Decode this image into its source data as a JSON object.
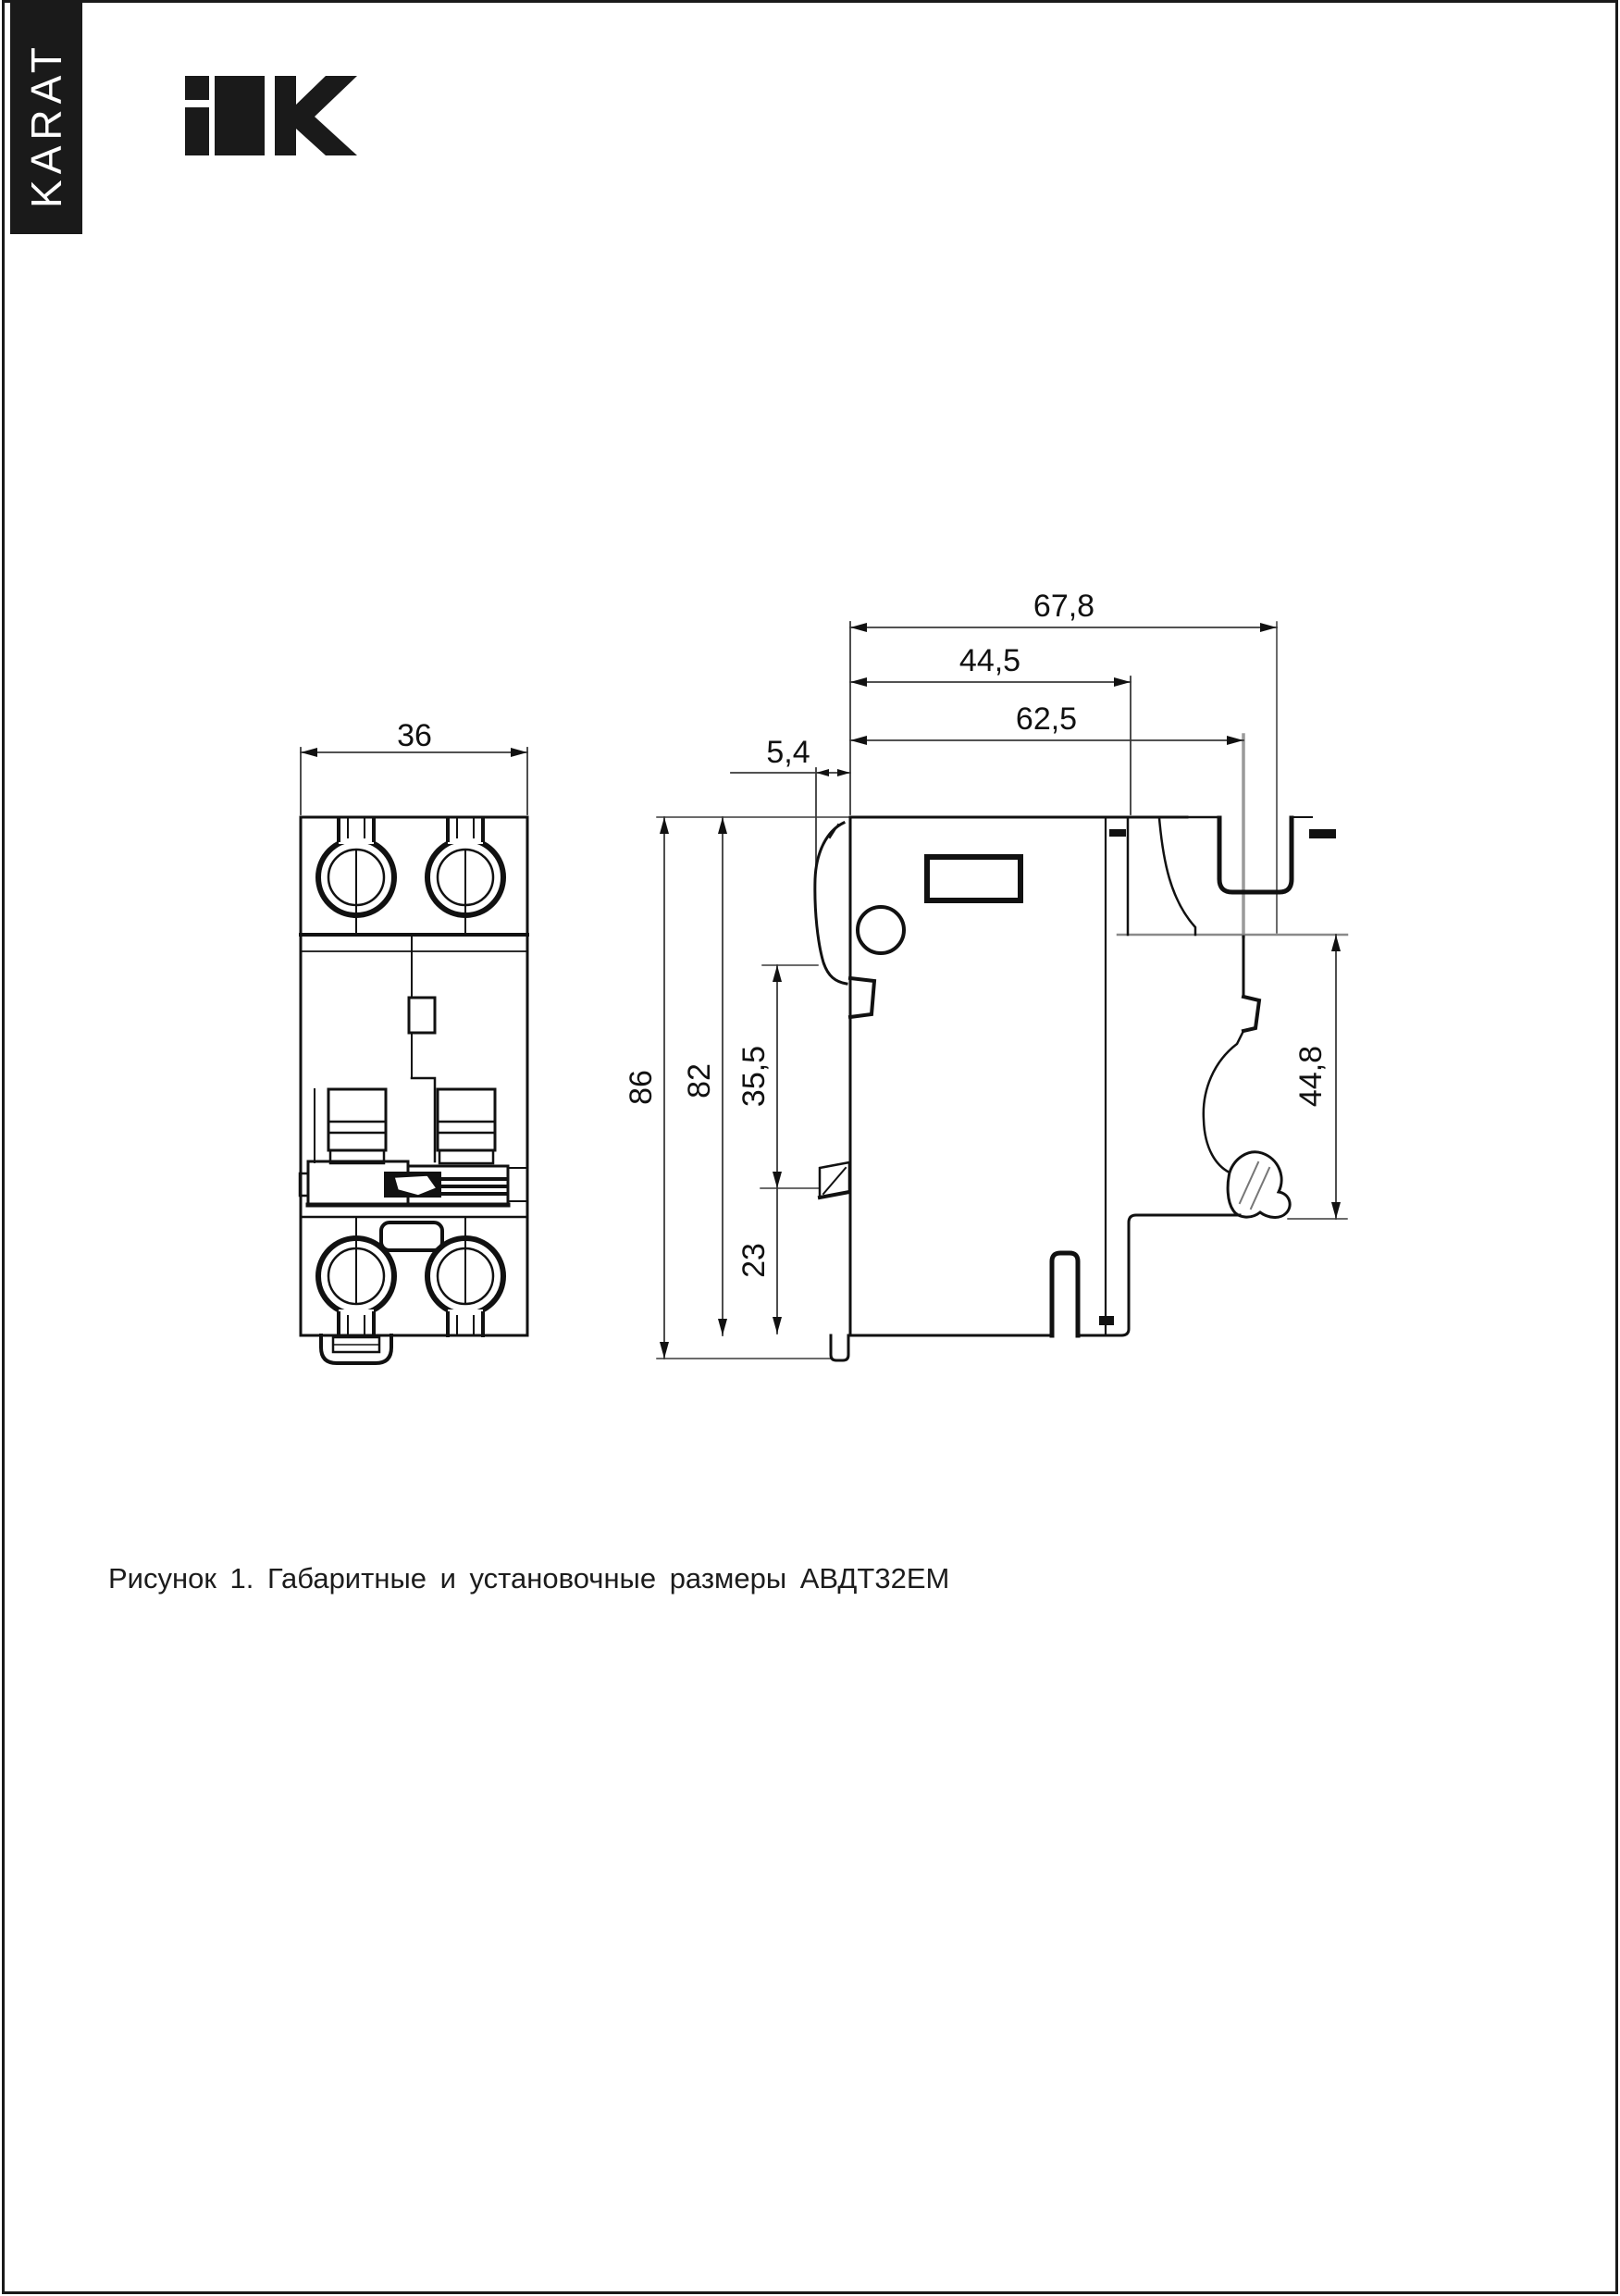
{
  "page": {
    "background": "#ffffff",
    "frame_color": "#1a1a1a"
  },
  "sidebar": {
    "series_label": "KARAT",
    "bg_color": "#1a1a1a",
    "text_color": "#ffffff"
  },
  "logo": {
    "brand": "IEK",
    "color": "#1a1a1a"
  },
  "figure": {
    "caption": "Рисунок 1. Габаритные и установочные размеры АВДТ32ЕМ",
    "front_view": {
      "width_mm": "36"
    },
    "side_view": {
      "overall_depth_mm": "67,8",
      "upper_depth_mm": "44,5",
      "rear_depth_mm": "62,5",
      "lever_protrusion_mm": "5,4",
      "overall_height_mm": "86",
      "body_height_mm": "82",
      "upper_section_mm": "35,5",
      "lower_section_mm": "23",
      "din_clip_height_mm": "44,8"
    }
  }
}
